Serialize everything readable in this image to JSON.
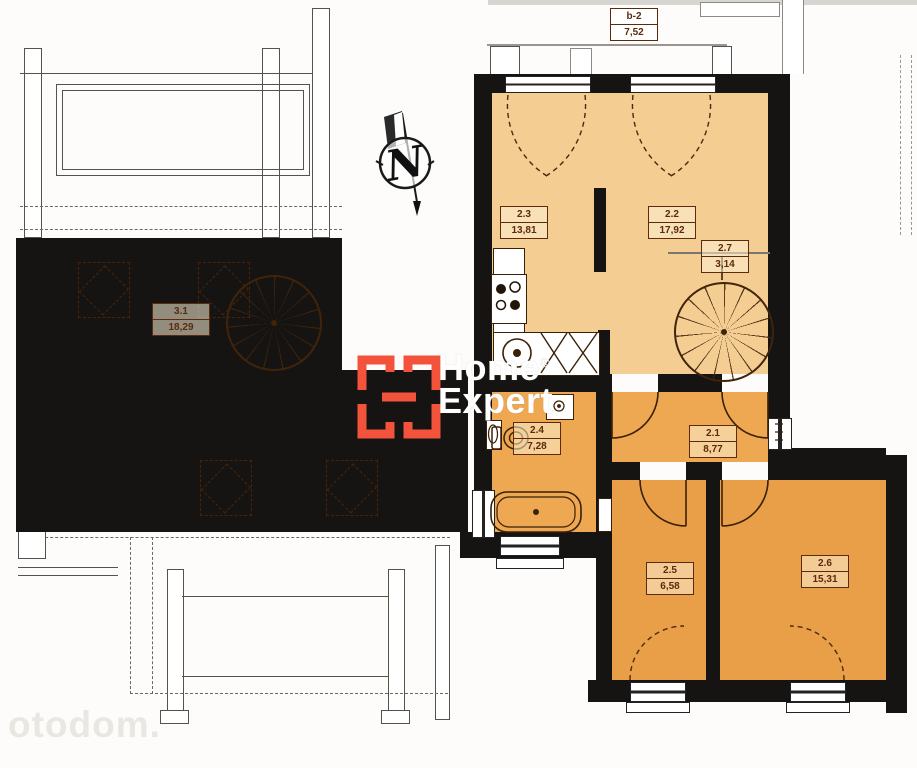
{
  "brand": {
    "word1": "Home",
    "registered": "®",
    "word2": "Expert"
  },
  "compass": {
    "north_letter": "N"
  },
  "watermark": {
    "portal": "otodom."
  },
  "rooms": {
    "b2": {
      "id": "b-2",
      "area": "7,52"
    },
    "r23": {
      "id": "2.3",
      "area": "13,81"
    },
    "r22": {
      "id": "2.2",
      "area": "17,92"
    },
    "r27": {
      "id": "2.7",
      "area": "3,14"
    },
    "r24": {
      "id": "2.4",
      "area": "7,28"
    },
    "r21": {
      "id": "2.1",
      "area": "8,77"
    },
    "r25": {
      "id": "2.5",
      "area": "6,58"
    },
    "r26": {
      "id": "2.6",
      "area": "15,31"
    },
    "r31": {
      "id": "3.1",
      "area": "18,29"
    }
  }
}
